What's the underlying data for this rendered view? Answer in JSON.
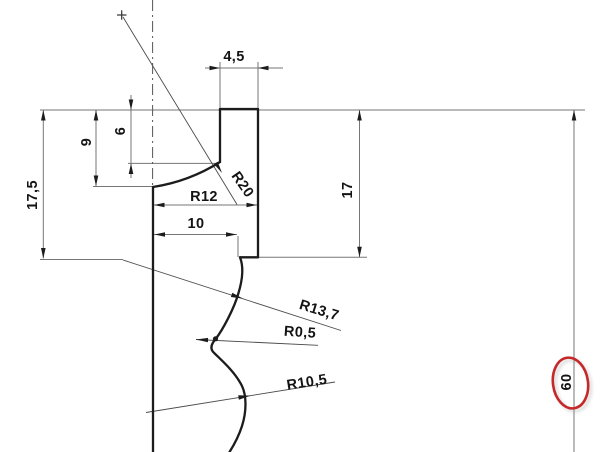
{
  "drawing": {
    "type": "CAD cross-section profile with dimensions",
    "colors": {
      "profile": "#1c1c1c",
      "dimension_lines": "#767676",
      "leader_lines": "#4a4a4a",
      "text": "#141414",
      "highlight_ellipse": "#c52828",
      "background": "#ffffff"
    },
    "dimensions": {
      "boss_width": "4,5",
      "depth_six": "6",
      "depth_nine": "9",
      "height_seventeen_five": "17,5",
      "height_seventeen": "17",
      "radius_twelve": "R12",
      "width_ten": "10",
      "radius_twenty": "R20",
      "radius_thirteen_seven": "R13,7",
      "radius_zero_five": "R0,5",
      "radius_ten_five": "R10,5",
      "height_sixty": "60"
    },
    "annotation": {
      "highlighted_dimension": "60"
    }
  }
}
